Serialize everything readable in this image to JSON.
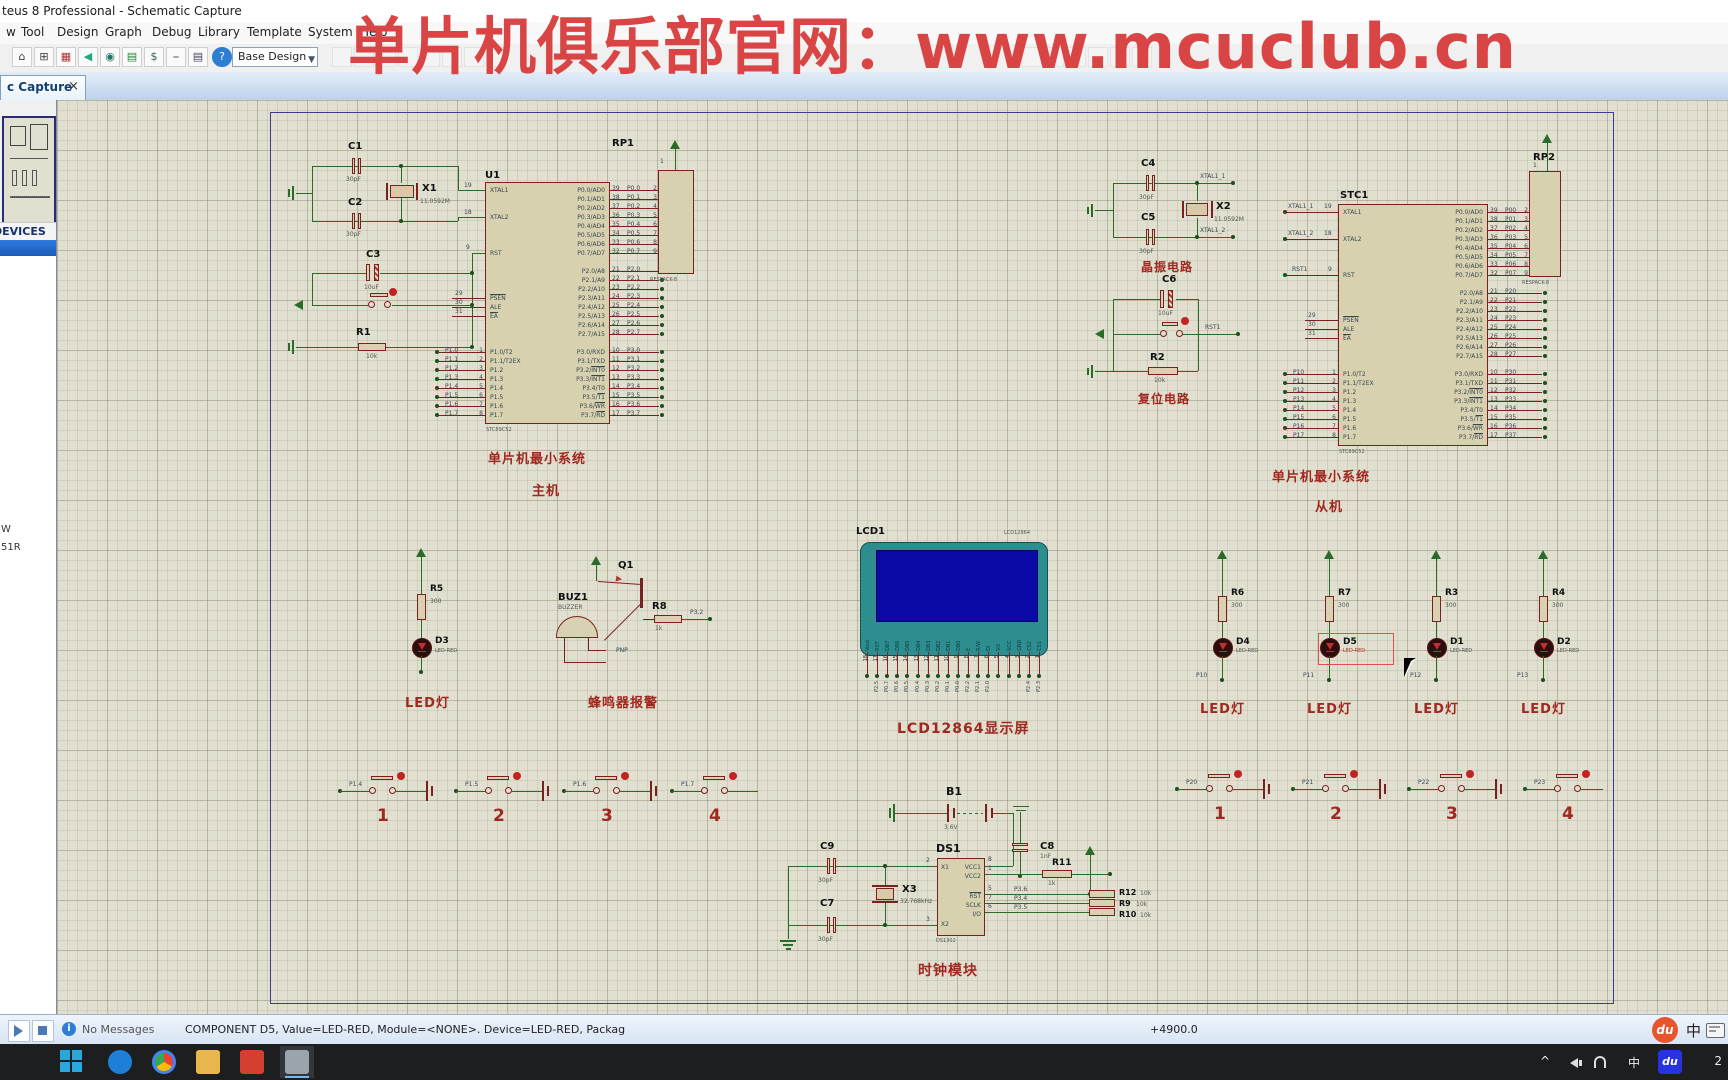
{
  "window": {
    "title": "teus 8 Professional - Schematic Capture"
  },
  "menu": {
    "items": [
      {
        "label": "w"
      },
      {
        "label": "Tool"
      },
      {
        "label": "Design"
      },
      {
        "label": "Graph"
      },
      {
        "label": "Debug"
      },
      {
        "label": "Library"
      },
      {
        "label": "Template"
      },
      {
        "label": "System"
      },
      {
        "label": "Help"
      }
    ]
  },
  "toolbar": {
    "combo_value": "Base Design",
    "help_label": "?"
  },
  "watermark": {
    "text": "单片机俱乐部官网：www.mcuclub.cn",
    "color": "#d94444"
  },
  "tab": {
    "label": "c Capture",
    "close": "×"
  },
  "sidebar": {
    "devices_header": "DEVICES",
    "items": [
      {
        "label": "W"
      },
      {
        "label": "51R"
      }
    ]
  },
  "status": {
    "no_messages": "No Messages",
    "message": "COMPONENT D5, Value=LED-RED, Module=<NONE>. Device=LED-RED, Packag",
    "coord": "+4900.0",
    "du": "du",
    "ime": "中"
  },
  "taskbar": {
    "tray_lang": "中",
    "du": "du",
    "clock": "2",
    "chevron": "^"
  },
  "sch": {
    "captions": {
      "min_sys1": "单片机最小系统",
      "master": "主机",
      "min_sys2": "单片机最小系统",
      "slave": "从机",
      "osc": "晶振电路",
      "reset": "复位电路",
      "led_l": "LED灯",
      "buzzer": "蜂鸣器报警",
      "lcd": "LCD12864显示屏",
      "clock": "时钟模块"
    },
    "u1": {
      "ref": "U1",
      "part": "STC89C52",
      "left": [
        {
          "t": "XTAL1"
        },
        {
          "t": ""
        },
        {
          "t": ""
        },
        {
          "t": "XTAL2"
        },
        {
          "t": ""
        },
        {
          "t": ""
        },
        {
          "t": ""
        },
        {
          "t": "RST"
        },
        {
          "t": ""
        },
        {
          "t": ""
        },
        {
          "t": ""
        },
        {
          "t": ""
        },
        {
          "t": "",
          "o": "PSEN"
        },
        {
          "t": "ALE"
        },
        {
          "t": "",
          "o": "EA"
        },
        {
          "t": ""
        },
        {
          "t": ""
        },
        {
          "t": ""
        },
        {
          "t": "P1.0/T2"
        },
        {
          "t": "P1.1/T2EX"
        },
        {
          "t": "P1.2"
        },
        {
          "t": "P1.3"
        },
        {
          "t": "P1.4"
        },
        {
          "t": "P1.5"
        },
        {
          "t": "P1.6"
        },
        {
          "t": "P1.7"
        }
      ],
      "right": [
        {
          "t": "P0.0/AD0"
        },
        {
          "t": "P0.1/AD1"
        },
        {
          "t": "P0.2/AD2"
        },
        {
          "t": "P0.3/AD3"
        },
        {
          "t": "P0.4/AD4"
        },
        {
          "t": "P0.5/AD5"
        },
        {
          "t": "P0.6/AD6"
        },
        {
          "t": "P0.7/AD7"
        },
        {
          "t": ""
        },
        {
          "t": "P2.0/A8"
        },
        {
          "t": "P2.1/A9"
        },
        {
          "t": "P2.2/A10"
        },
        {
          "t": "P2.3/A11"
        },
        {
          "t": "P2.4/A12"
        },
        {
          "t": "P2.5/A13"
        },
        {
          "t": "P2.6/A14"
        },
        {
          "t": "P2.7/A15"
        },
        {
          "t": ""
        },
        {
          "t": "P3.0/RXD"
        },
        {
          "t": "P3.1/TXD"
        },
        {
          "t": "P3.2/",
          "o": "INT0"
        },
        {
          "t": "P3.3/",
          "o": "INT1"
        },
        {
          "t": "P3.4/T0"
        },
        {
          "t": "P3.5/",
          "o": "T1"
        },
        {
          "t": "P3.6/",
          "o": "WR"
        },
        {
          "t": "P3.7/",
          "o": "RD"
        }
      ]
    },
    "stc1": {
      "ref": "STC1",
      "part": "STC89C52"
    },
    "rp1": {
      "ref": "RP1",
      "part": "RESPACK-8",
      "pin1": "1"
    },
    "rp2": {
      "ref": "RP2",
      "part": "RESPACK-8",
      "pin1": "1"
    },
    "stubs": {
      "u1_p1": [
        {
          "net": "P1.0",
          "no": "1"
        },
        {
          "net": "P1.1",
          "no": "2"
        },
        {
          "net": "P1.2",
          "no": "3"
        },
        {
          "net": "P1.3",
          "no": "4"
        },
        {
          "net": "P1.4",
          "no": "5"
        },
        {
          "net": "P1.5",
          "no": "6"
        },
        {
          "net": "P1.6",
          "no": "7"
        },
        {
          "net": "P1.7",
          "no": "8"
        }
      ],
      "u1_p0": [
        {
          "no": "39",
          "net": "P0.0",
          "rp": "2"
        },
        {
          "no": "38",
          "net": "P0.1",
          "rp": "3"
        },
        {
          "no": "37",
          "net": "P0.2",
          "rp": "4"
        },
        {
          "no": "36",
          "net": "P0.3",
          "rp": "5"
        },
        {
          "no": "35",
          "net": "P0.4",
          "rp": "6"
        },
        {
          "no": "34",
          "net": "P0.5",
          "rp": "7"
        },
        {
          "no": "33",
          "net": "P0.6",
          "rp": "8"
        },
        {
          "no": "32",
          "net": "P0.7",
          "rp": "9"
        }
      ],
      "u1_p2": [
        {
          "no": "21",
          "net": "P2.0"
        },
        {
          "no": "22",
          "net": "P2.1"
        },
        {
          "no": "23",
          "net": "P2.2"
        },
        {
          "no": "24",
          "net": "P2.3"
        },
        {
          "no": "25",
          "net": "P2.4"
        },
        {
          "no": "26",
          "net": "P2.5"
        },
        {
          "no": "27",
          "net": "P2.6"
        },
        {
          "no": "28",
          "net": "P2.7"
        }
      ],
      "u1_p3": [
        {
          "no": "10",
          "net": "P3.0"
        },
        {
          "no": "11",
          "net": "P3.1"
        },
        {
          "no": "12",
          "net": "P3.2"
        },
        {
          "no": "13",
          "net": "P3.3"
        },
        {
          "no": "14",
          "net": "P3.4"
        },
        {
          "no": "15",
          "net": "P3.5"
        },
        {
          "no": "16",
          "net": "P3.6"
        },
        {
          "no": "17",
          "net": "P3.7"
        }
      ],
      "s_p1": [
        {
          "net": "P10",
          "no": "1"
        },
        {
          "net": "P11",
          "no": "2"
        },
        {
          "net": "P12",
          "no": "3"
        },
        {
          "net": "P13",
          "no": "4"
        },
        {
          "net": "P14",
          "no": "5"
        },
        {
          "net": "P15",
          "no": "6"
        },
        {
          "net": "P16",
          "no": "7"
        },
        {
          "net": "P17",
          "no": "8"
        }
      ],
      "s_p0": [
        {
          "no": "39",
          "net": "P00",
          "rp": "2"
        },
        {
          "no": "38",
          "net": "P01",
          "rp": "3"
        },
        {
          "no": "37",
          "net": "P02",
          "rp": "4"
        },
        {
          "no": "36",
          "net": "P03",
          "rp": "5"
        },
        {
          "no": "35",
          "net": "P04",
          "rp": "6"
        },
        {
          "no": "34",
          "net": "P05",
          "rp": "7"
        },
        {
          "no": "33",
          "net": "P06",
          "rp": "8"
        },
        {
          "no": "32",
          "net": "P07",
          "rp": "9"
        }
      ],
      "s_p2": [
        {
          "no": "21",
          "net": "P20"
        },
        {
          "no": "22",
          "net": "P21"
        },
        {
          "no": "23",
          "net": "P22"
        },
        {
          "no": "24",
          "net": "P23"
        },
        {
          "no": "25",
          "net": "P24"
        },
        {
          "no": "26",
          "net": "P25"
        },
        {
          "no": "27",
          "net": "P26"
        },
        {
          "no": "28",
          "net": "P27"
        }
      ],
      "s_p3": [
        {
          "no": "10",
          "net": "P30"
        },
        {
          "no": "11",
          "net": "P31"
        },
        {
          "no": "12",
          "net": "P32"
        },
        {
          "no": "13",
          "net": "P33"
        },
        {
          "no": "14",
          "net": "P34"
        },
        {
          "no": "15",
          "net": "P35"
        },
        {
          "no": "16",
          "net": "P36"
        },
        {
          "no": "17",
          "net": "P37"
        }
      ],
      "ctrl": {
        "a": "29",
        "b": "30",
        "c": "31"
      },
      "xtal": {
        "x1": "19",
        "x2": "18",
        "rst": "9"
      },
      "s_xtal": {
        "n1": "XTAL1_1",
        "n2": "XTAL1_2",
        "n3": "RST1",
        "x1": "19",
        "x2": "18",
        "rst": "9"
      }
    },
    "osc1": {
      "c1": "C1",
      "c1v": "30pF",
      "c2": "C2",
      "c2v": "30pF",
      "x": "X1",
      "xv": "11.0592M"
    },
    "rst1": {
      "c": "C3",
      "cv": "10uF",
      "r": "R1",
      "rv": "10k"
    },
    "osc2": {
      "c1": "C4",
      "c1v": "30pF",
      "c2": "C5",
      "c2v": "30pF",
      "x": "X2",
      "xv": "11.0592M",
      "n1": "XTAL1_1",
      "n2": "XTAL1_2"
    },
    "rst2": {
      "c": "C6",
      "cv": "10uF",
      "r": "R2",
      "rv": "10k",
      "net": "RST1"
    },
    "led_l": {
      "r": "R5",
      "rv": "300",
      "d": "D3",
      "dv": "LED-RED"
    },
    "buz": {
      "ref": "BUZ1",
      "part": "BUZZER",
      "q": "Q1",
      "qt": "PNP",
      "r": "R8",
      "rv": "1k",
      "net": "P3.2"
    },
    "lcd": {
      "ref": "LCD1",
      "part": "LCD12864",
      "pins": [
        {
          "no": "18",
          "name": "Vout",
          "net": ""
        },
        {
          "no": "17",
          "name": "RST",
          "net": "P2.5"
        },
        {
          "no": "16",
          "name": "DB7",
          "net": "P0.7"
        },
        {
          "no": "15",
          "name": "DB6",
          "net": "P0.6"
        },
        {
          "no": "14",
          "name": "DB5",
          "net": "P0.5"
        },
        {
          "no": "13",
          "name": "DB4",
          "net": "P0.4"
        },
        {
          "no": "12",
          "name": "DB3",
          "net": "P0.3"
        },
        {
          "no": "11",
          "name": "DB2",
          "net": "P0.2"
        },
        {
          "no": "10",
          "name": "DB1",
          "net": "P0.1"
        },
        {
          "no": "9",
          "name": "DB0",
          "net": "P0.0"
        },
        {
          "no": "8",
          "name": "E",
          "net": "P2.2"
        },
        {
          "no": "7",
          "name": "R/W",
          "net": "P2.1"
        },
        {
          "no": "6",
          "name": "DI",
          "net": "P2.0"
        },
        {
          "no": "5",
          "name": "VO",
          "net": ""
        },
        {
          "no": "4",
          "name": "VCC",
          "net": ""
        },
        {
          "no": "3",
          "name": "GND",
          "net": ""
        },
        {
          "no": "2",
          "name": "CS2",
          "net": "P2.4"
        },
        {
          "no": "1",
          "name": "CS1",
          "net": "P2.3"
        }
      ]
    },
    "leds": [
      {
        "r": "R6",
        "rv": "300",
        "d": "D4",
        "dv": "LED-RED",
        "net": "P10",
        "cap": "LED灯"
      },
      {
        "r": "R7",
        "rv": "300",
        "d": "D5",
        "dv": "LED-RED",
        "net": "P11",
        "cap": "LED灯"
      },
      {
        "r": "R3",
        "rv": "300",
        "d": "D1",
        "dv": "LED-RED",
        "net": "P12",
        "cap": "LED灯"
      },
      {
        "r": "R4",
        "rv": "300",
        "d": "D2",
        "dv": "LED-RED",
        "net": "P13",
        "cap": "LED灯"
      }
    ],
    "btnL": [
      {
        "net": "P1.4",
        "num": "1"
      },
      {
        "net": "P1.5",
        "num": "2"
      },
      {
        "net": "P1.6",
        "num": "3"
      },
      {
        "net": "P1.7",
        "num": "4"
      }
    ],
    "btnR": [
      {
        "net": "P20",
        "num": "1"
      },
      {
        "net": "P21",
        "num": "2"
      },
      {
        "net": "P22",
        "num": "3"
      },
      {
        "net": "P23",
        "num": "4"
      }
    ],
    "clk": {
      "b": "B1",
      "bv": "3.6V",
      "c9": "C9",
      "c9v": "30pF",
      "c7": "C7",
      "c7v": "30pF",
      "x": "X3",
      "xv": "32.768kHz",
      "u": "DS1",
      "part": "DS1302",
      "c8": "C8",
      "c8v": "1nF",
      "r11": "R11",
      "r11v": "1k",
      "r12": "R12",
      "r12v": "10k",
      "r9": "R9",
      "r9v": "10k",
      "r10": "R10",
      "r10v": "10k",
      "n1": "P3.6",
      "n2": "P3.4",
      "n3": "P3.5",
      "pins": {
        "x1": "X1",
        "x2": "X2",
        "vcc1": "VCC1",
        "vcc2": "VCC2",
        "rst": "RST",
        "sclk": "SCLK",
        "io": "I/O",
        "n_x1": "2",
        "n_x2": "3",
        "n_vcc1": "8",
        "n_vcc2": "1",
        "n_rst": "5",
        "n_sclk": "7",
        "n_io": "6"
      }
    }
  }
}
